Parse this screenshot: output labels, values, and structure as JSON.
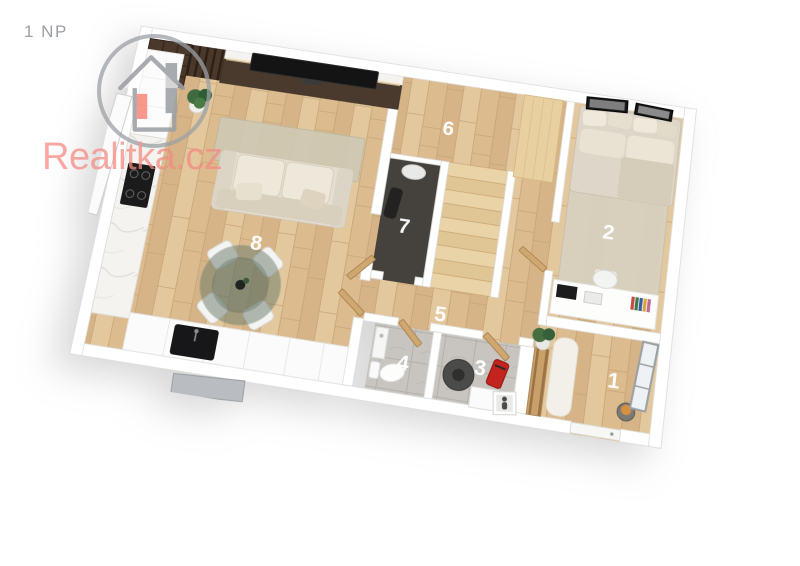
{
  "page": {
    "floor_label": "1 NP"
  },
  "watermark": {
    "brand": "Realitka.cz"
  },
  "rooms": [
    {
      "label": "1"
    },
    {
      "label": "2"
    },
    {
      "label": "3"
    },
    {
      "label": "4"
    },
    {
      "label": "5"
    },
    {
      "label": "6"
    },
    {
      "label": "7"
    },
    {
      "label": "8"
    }
  ],
  "colors": {
    "brand_red": "#f38b81",
    "logo_gray": "#9ba0a4",
    "wood_floor": "#ddbe93",
    "wall_white": "#ffffff",
    "tile_gray": "#c8c4bf",
    "dark_room_floor": "#45423e",
    "dark_furniture": "#4a382b"
  }
}
